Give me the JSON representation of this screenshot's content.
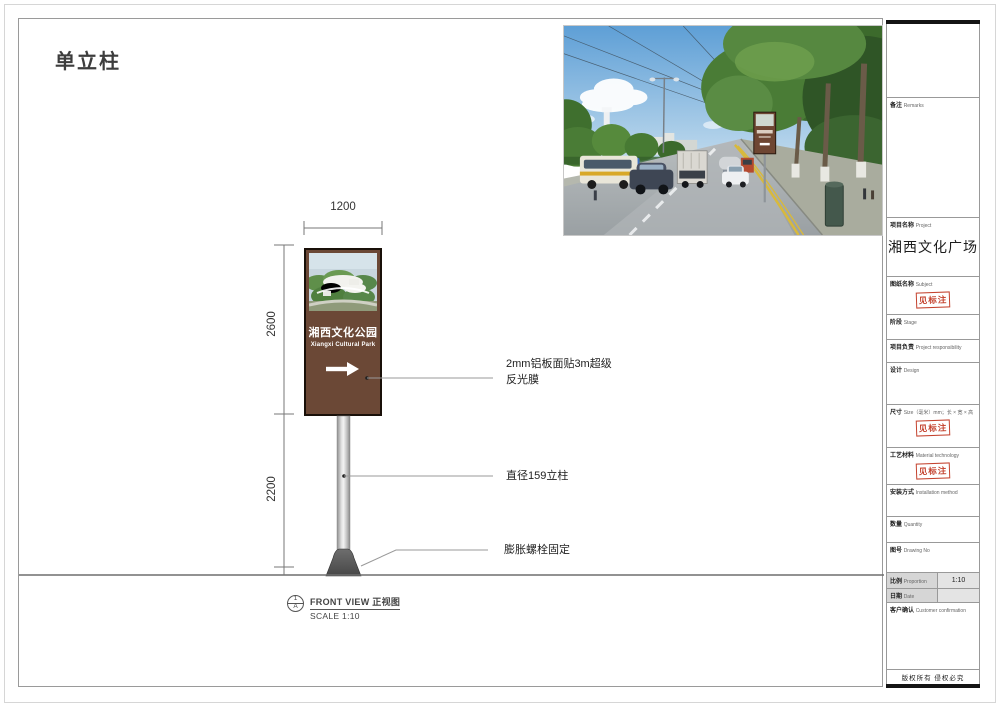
{
  "page": {
    "title": "单立柱"
  },
  "colors": {
    "sign_brown": "#6b4836",
    "stamp_red": "#c4432f"
  },
  "photo": {
    "sign_text": "湘西文化公园"
  },
  "drawing": {
    "dim_width": "1200",
    "dim_height_upper": "2600",
    "dim_height_lower": "2200",
    "sign": {
      "title": "湘西文化公园",
      "subtitle": "Xiangxi Cultural Park"
    },
    "annotations": {
      "panel_material_line1": "2mm铝板面贴3m超级",
      "panel_material_line2": "反光膜",
      "pole": "直径159立柱",
      "anchor": "膨胀螺栓固定"
    },
    "view": {
      "num": "1",
      "sheet": "A",
      "title": "FRONT VIEW 正视图",
      "scale": "SCALE 1:10"
    }
  },
  "titleblock": {
    "stamp": "见标注",
    "rows": {
      "remarks": {
        "cn": "备注",
        "en": "Remarks"
      },
      "project": {
        "cn": "项目名称",
        "en": "Project",
        "value": "湘西文化广场"
      },
      "subject": {
        "cn": "图纸名称",
        "en": "Subject"
      },
      "stage": {
        "cn": "阶段",
        "en": "Stage"
      },
      "responsibility": {
        "cn": "项目负责",
        "en": "Project responsibility"
      },
      "design": {
        "cn": "设计",
        "en": "Design"
      },
      "size": {
        "cn": "尺寸",
        "en": "Size（毫米）mm；长 × 宽 × 高"
      },
      "material": {
        "cn": "工艺材料",
        "en": "Material technology"
      },
      "installation": {
        "cn": "安装方式",
        "en": "Installation method"
      },
      "quantity": {
        "cn": "数量",
        "en": "Quantity"
      },
      "drawing_no": {
        "cn": "图号",
        "en": "Drawing No"
      },
      "proportion": {
        "cn": "比例",
        "en": "Proportion",
        "value": "1:10"
      },
      "date": {
        "cn": "日期",
        "en": "Date"
      },
      "confirmation": {
        "cn": "客户确认",
        "en": "Customer confirmation"
      }
    },
    "footer": "版权所有  侵权必究"
  }
}
